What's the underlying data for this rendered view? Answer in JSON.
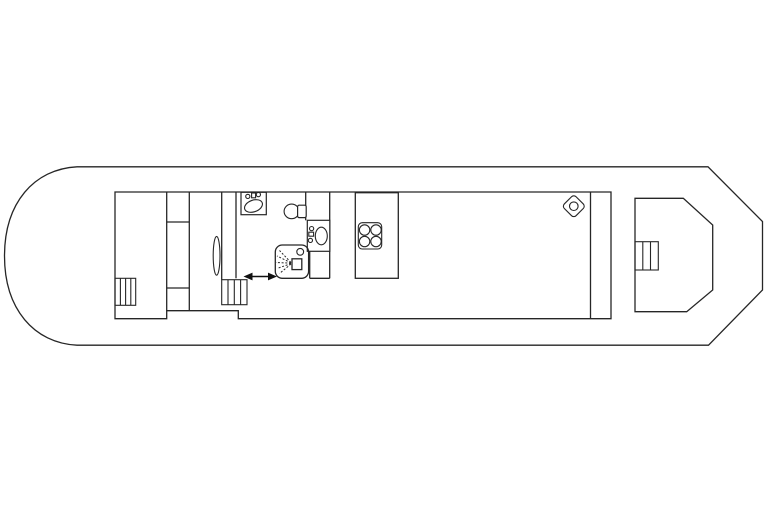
{
  "meta": {
    "content_kind": "boat-deck-floor-plan-line-drawing",
    "background_color": "#ffffff",
    "line_color": "#262626",
    "visible_text": ""
  },
  "plan": {
    "hull": "rounded-bow-left-chamfered-stern-right",
    "icons": [
      {
        "name": "stairs-icon",
        "position": "forward-cabin-bottom-left"
      },
      {
        "name": "oval-table-icon",
        "position": "forward-room"
      },
      {
        "name": "washbasin-icon",
        "position": "bathroom-top-wall"
      },
      {
        "name": "toilet-icon",
        "position": "bathroom-center"
      },
      {
        "name": "washbasin-icon",
        "position": "bathroom-right-wall"
      },
      {
        "name": "shower-icon",
        "position": "bathroom-bottom"
      },
      {
        "name": "double-arrow-icon",
        "position": "bathroom-doorway"
      },
      {
        "name": "stairs-icon",
        "position": "midship-corridor"
      },
      {
        "name": "stove-4-burner-icon",
        "position": "galley-counter"
      },
      {
        "name": "diamond-hatch-icon",
        "position": "saloon-aft-corner"
      },
      {
        "name": "stairs-icon",
        "position": "aft-deck-structure"
      }
    ]
  }
}
